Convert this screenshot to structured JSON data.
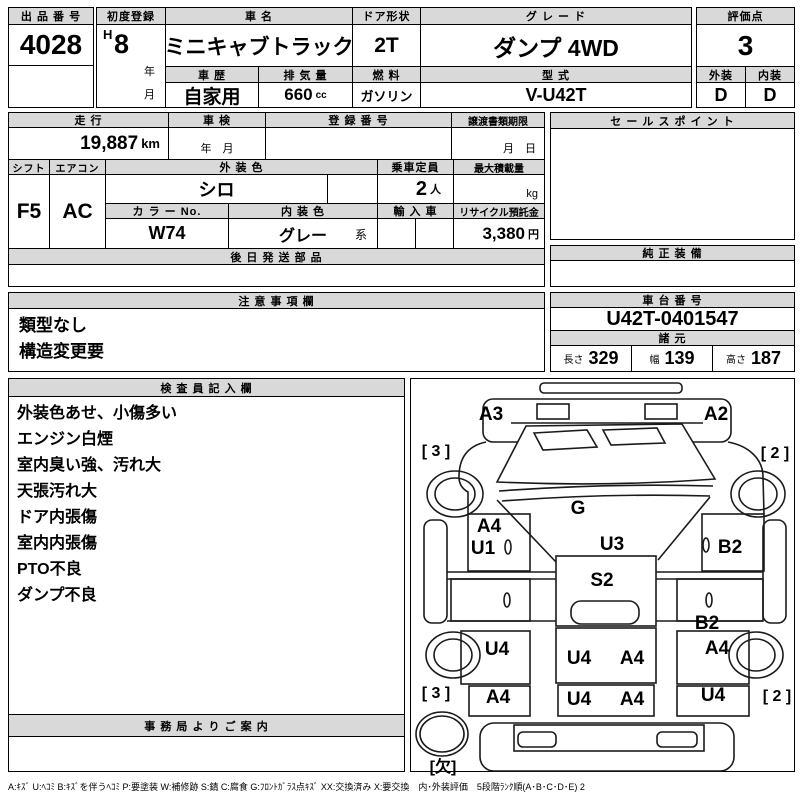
{
  "top": {
    "auction_no_label": "出 品 番 号",
    "auction_no": "4028",
    "first_reg_label": "初度登録",
    "first_reg_era": "H",
    "first_reg_year": "8",
    "year_suffix": "年",
    "month_suffix": "月",
    "car_name_label": "車 名",
    "car_name": "ミニキャブトラック",
    "door_label": "ドア形状",
    "door": "2T",
    "grade_label": "グ レ ー ド",
    "grade": "ダンプ 4WD",
    "score_label": "評価点",
    "score": "3",
    "history_label": "車 歴",
    "history": "自家用",
    "displacement_label": "排 気 量",
    "displacement": "660",
    "displacement_unit": "cc",
    "fuel_label": "燃 料",
    "fuel": "ガソリン",
    "model_label": "型 式",
    "model": "V-U42T",
    "exterior_label": "外装",
    "interior_label": "内装",
    "exterior_grade": "D",
    "interior_grade": "D"
  },
  "info": {
    "mileage_label": "走 行",
    "mileage": "19,887",
    "mileage_unit": "km",
    "inspection_label": "車 検",
    "inspection_value": "年　月",
    "reg_no_label": "登 録 番 号",
    "transfer_label": "譲渡書類期限",
    "transfer_value": "月　日",
    "shift_label": "シフト",
    "shift": "F5",
    "aircon_label": "エアコン",
    "aircon": "AC",
    "ext_color_label": "外 装 色",
    "ext_color": "シロ",
    "capacity_label": "乗車定員",
    "capacity": "2",
    "capacity_unit": "人",
    "max_load_label": "最大積載量",
    "max_load_unit": "kg",
    "color_no_label": "カ ラ ー No.",
    "color_no": "W74",
    "int_color_label": "内 装 色",
    "int_color": "グレー",
    "int_color_suffix": "系",
    "import_label": "輸 入 車",
    "recycle_label": "リサイクル預託金",
    "recycle_fee": "3,380",
    "recycle_unit": "円",
    "later_parts_label": "後 日 発 送 部 品"
  },
  "notes": {
    "label": "注 意 事 項 欄",
    "lines": [
      "類型なし",
      "構造変更要"
    ]
  },
  "sales": {
    "label": "セ ー ル ス ポ イ ン ト"
  },
  "equipment": {
    "label": "純 正 装 備"
  },
  "chassis": {
    "label": "車 台 番 号",
    "number": "U42T-0401547",
    "specs_label": "諸 元",
    "length_label": "長さ",
    "length": "329",
    "width_label": "幅",
    "width": "139",
    "height_label": "高さ",
    "height": "187"
  },
  "inspector": {
    "label": "検 査 員 記 入 欄",
    "lines": [
      "外装色あせ、小傷多い",
      "エンジン白煙",
      "室内臭い強、汚れ大",
      "天張汚れ大",
      "ドア内張傷",
      "室内内張傷",
      "PTO不良",
      "ダンプ不良"
    ],
    "office_label": "事 務 局 よ り ご 案 内"
  },
  "diagram": {
    "labels": [
      "A3",
      "A2",
      "[ 3 ]",
      "[ 2 ]",
      "G",
      "A4",
      "U1",
      "U3",
      "B2",
      "S2",
      "B2",
      "U4",
      "A4",
      "U4",
      "A4",
      "[ 3 ]",
      "A4",
      "U4",
      "A4",
      "U4",
      "[ 2 ]",
      "[欠]"
    ]
  },
  "legend": "A:ｷｽﾞ U:ﾍｺﾐ B:ｷｽﾞを伴うﾍｺﾐ P:要塗装 W:補修跡 S:錆 C:腐食 G:ﾌﾛﾝﾄｶﾞﾗｽ点ｷｽﾞ XX:交換済み X:要交換　内･外装評価　5段階ﾗﾝｸ順(A･B･C･D･E) 2"
}
